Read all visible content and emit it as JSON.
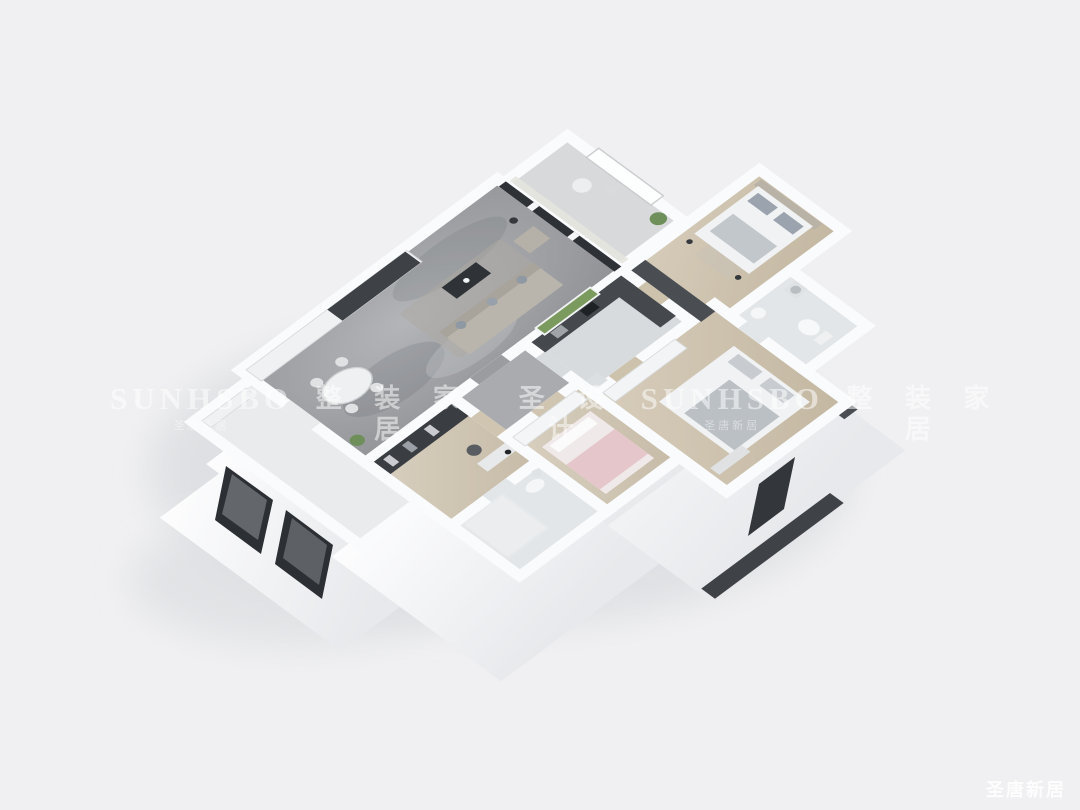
{
  "background_color": "#f0f0f2",
  "watermark": {
    "text_color": "#ffffff",
    "segments": [
      {
        "text": "SUNHSBO",
        "sub": "圣唐新居"
      },
      {
        "text": "整 装 家 居",
        "sub": ""
      },
      {
        "text": "圣 设 计",
        "sub": ""
      },
      {
        "text": "SUNHSBO",
        "sub": "圣唐新居"
      },
      {
        "text": "整 装 家 居",
        "sub": ""
      }
    ],
    "corner_logo": "圣唐新居"
  },
  "palette": {
    "wall": "#fafbfd",
    "wall_face": "#f4f5f7",
    "wall_face_dark": "#43474c",
    "marble_floor_light": "#b3b5b9",
    "marble_floor_dark": "#8b8d91",
    "wood_floor_light": "#d9d0c0",
    "wood_floor_dark": "#c3b7a1",
    "tile_floor": "#e3e6e8",
    "hall_floor": "#a9abaf",
    "balcony_floor": "#d7d9db",
    "foyer_floor": "#e9ebed",
    "glass_dark": "#2e3236",
    "greenery": "#7b9a5e",
    "bed_linen": "#f1f2f3",
    "pink_bed": "#e5c6ca",
    "sofa_gray": "#b9b5ad",
    "shadow": "#dcdee1"
  }
}
